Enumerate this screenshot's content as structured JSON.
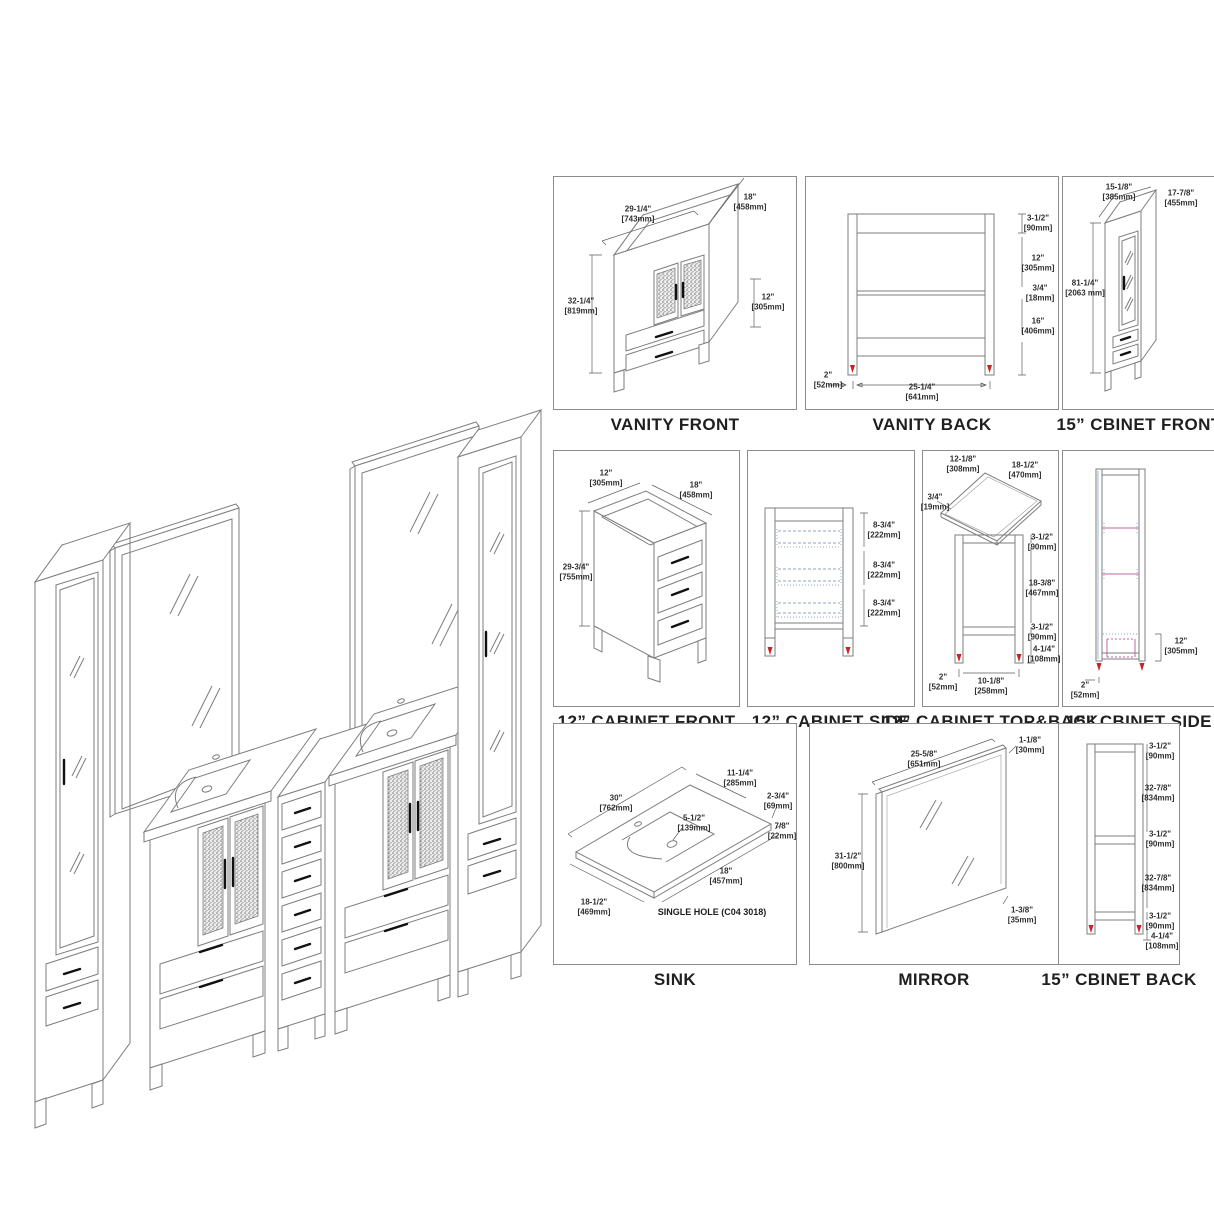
{
  "colors": {
    "line": "#7e7e7e",
    "dimension_text": "#2e2e2e",
    "foot_marker_red": "#c42424",
    "slide_dash_blue": "#8fa3c2",
    "shelf_magenta": "#c06aa0"
  },
  "panels": {
    "vanity_front": {
      "caption": "VANITY FRONT",
      "dims": {
        "width": {
          "in": "29-1/4\"",
          "mm": "[743mm]"
        },
        "depth": {
          "in": "18\"",
          "mm": "[458mm]"
        },
        "height": {
          "in": "32-1/4\"",
          "mm": "[819mm]"
        },
        "drawer": {
          "in": "12\"",
          "mm": "[305mm]"
        }
      }
    },
    "vanity_back": {
      "caption": "VANITY BACK",
      "dims": {
        "top_rail": {
          "in": "3-1/2\"",
          "mm": "[90mm]"
        },
        "upper": {
          "in": "12\"",
          "mm": "[305mm]"
        },
        "mid_rail": {
          "in": "3/4\"",
          "mm": "[18mm]"
        },
        "lower": {
          "in": "16\"",
          "mm": "[406mm]"
        },
        "leg": {
          "in": "2\"",
          "mm": "[52mm]"
        },
        "span": {
          "in": "25-1/4\"",
          "mm": "[641mm]"
        }
      }
    },
    "cbinet15_front": {
      "caption": "15” CBINET FRONT",
      "dims": {
        "width": {
          "in": "15-1/8\"",
          "mm": "[385mm]"
        },
        "depth": {
          "in": "17-7/8\"",
          "mm": "[455mm]"
        },
        "height": {
          "in": "81-1/4\"",
          "mm": "[2063 mm]"
        }
      }
    },
    "cabinet12_front": {
      "caption": "12” CABINET FRONT",
      "dims": {
        "width": {
          "in": "12\"",
          "mm": "[305mm]"
        },
        "depth": {
          "in": "18\"",
          "mm": "[458mm]"
        },
        "height": {
          "in": "29-3/4\"",
          "mm": "[755mm]"
        }
      }
    },
    "cabinet12_side": {
      "caption": "12” CABINET SIDE",
      "dims": {
        "bay1": {
          "in": "8-3/4\"",
          "mm": "[222mm]"
        },
        "bay2": {
          "in": "8-3/4\"",
          "mm": "[222mm]"
        },
        "bay3": {
          "in": "8-3/4\"",
          "mm": "[222mm]"
        }
      }
    },
    "cabinet12_topback": {
      "caption": "12” CABINET TOP&BACK",
      "dims": {
        "top_w": {
          "in": "12-1/8\"",
          "mm": "[308mm]"
        },
        "top_d": {
          "in": "18-1/2\"",
          "mm": "[470mm]"
        },
        "top_t": {
          "in": "3/4\"",
          "mm": "[19mm]"
        },
        "rail_top": {
          "in": "3-1/2\"",
          "mm": "[90mm]"
        },
        "mid": {
          "in": "18-3/8\"",
          "mm": "[467mm]"
        },
        "rail_low": {
          "in": "3-1/2\"",
          "mm": "[90mm]"
        },
        "foot": {
          "in": "4-1/4\"",
          "mm": "[108mm]"
        },
        "leg": {
          "in": "2\"",
          "mm": "[52mm]"
        },
        "span": {
          "in": "10-1/8\"",
          "mm": "[258mm]"
        }
      }
    },
    "cbinet15_side": {
      "caption": "15” CBINET SIDE",
      "dims": {
        "drawer": {
          "in": "12\"",
          "mm": "[305mm]"
        },
        "leg": {
          "in": "2\"",
          "mm": "[52mm]"
        }
      }
    },
    "sink": {
      "caption": "SINK",
      "note": "SINGLE HOLE (C04 3018)",
      "dims": {
        "width": {
          "in": "30\"",
          "mm": "[762mm]"
        },
        "basin_w": {
          "in": "11-1/4\"",
          "mm": "[285mm]"
        },
        "edge": {
          "in": "2-3/4\"",
          "mm": "[69mm]"
        },
        "thick": {
          "in": "7/8\"",
          "mm": "[22mm]"
        },
        "basin_d": {
          "in": "5-1/2\"",
          "mm": "[139mm]"
        },
        "front": {
          "in": "18\"",
          "mm": "[457mm]"
        },
        "depth": {
          "in": "18-1/2\"",
          "mm": "[469mm]"
        }
      }
    },
    "mirror": {
      "caption": "MIRROR",
      "dims": {
        "width": {
          "in": "25-5/8\"",
          "mm": "[651mm]"
        },
        "thick": {
          "in": "1-1/8\"",
          "mm": "[30mm]"
        },
        "height": {
          "in": "31-1/2\"",
          "mm": "[800mm]"
        },
        "frame": {
          "in": "1-3/8\"",
          "mm": "[35mm]"
        }
      }
    },
    "cbinet15_back": {
      "caption": "15” CBINET BACK",
      "dims": {
        "rail1": {
          "in": "3-1/2\"",
          "mm": "[90mm]"
        },
        "panel1": {
          "in": "32-7/8\"",
          "mm": "[834mm]"
        },
        "rail2": {
          "in": "3-1/2\"",
          "mm": "[90mm]"
        },
        "panel2": {
          "in": "32-7/8\"",
          "mm": "[834mm]"
        },
        "rail3": {
          "in": "3-1/2\"",
          "mm": "[90mm]"
        },
        "foot": {
          "in": "4-1/4\"",
          "mm": "[108mm]"
        }
      }
    }
  }
}
